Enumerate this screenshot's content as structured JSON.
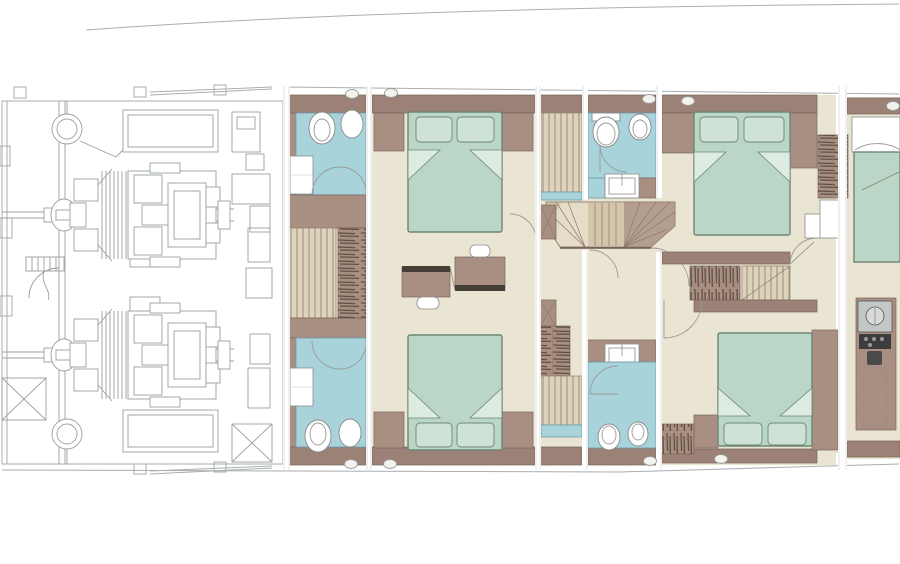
{
  "plan": {
    "kind": "yacht-lower-deck-floor-plan",
    "counts": {
      "engines": 2,
      "cabins": 4,
      "partial_cabins": 1,
      "bathrooms": 4,
      "double_beds": 5,
      "toilets": 4,
      "sinks": 4,
      "bidets": 2,
      "slatted_showers": 2,
      "staircases": 2,
      "vanity_desks": 2,
      "hanging_wardrobes": 5,
      "portholes": 9
    }
  },
  "colors": {
    "background": "#ffffff",
    "hull_line": "#a9aeae",
    "engine_line": "#9aa0a0",
    "wall": "#9c8276",
    "wall_mid": "#a98f82",
    "wall_edge": "#77645a",
    "floor": "#eae4d3",
    "bath": "#a9d3db",
    "bath_edge": "#6f9aa6",
    "bed": "#b9d6c7",
    "pillow": "#cfe2d6",
    "bed_edge": "#6e8577",
    "fold": "#ddebe2",
    "slat_bg": "#ded3bd",
    "slat_line": "#9a8c74",
    "tread_light": "#e6ddc9",
    "tread_mid": "#d3c6ab",
    "tread_taupe": "#b49e90",
    "desk_dark": "#453e37",
    "equip_panel": "#c3c7c7",
    "equip_dark": "#3d3d3d",
    "white": "#ffffff",
    "hanger_line": "#5f4f44"
  }
}
